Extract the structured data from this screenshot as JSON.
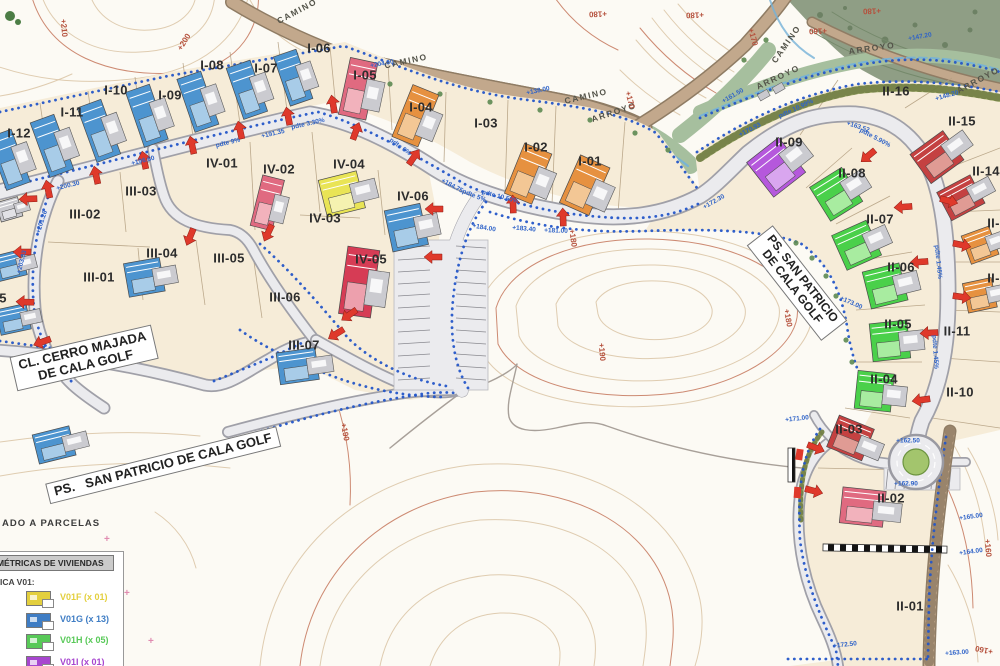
{
  "map_title": "Plano de parcelación - Cala Golf",
  "colors": {
    "paper": "#fcfaf4",
    "parcel": "#f6ecd8",
    "road_fill": "#ebebee",
    "road_edge": "#a0a0a8",
    "boundary_dots": "#2456c8",
    "arrow": "#df392b",
    "contour": "#dcc7a8",
    "contour_index": "#c4765a",
    "camino": "#c2a88c",
    "camino_edge": "#8f7c64",
    "arroyo_strip": "#a6bf9e",
    "forest": "#89997e",
    "bank": "#93a35b",
    "stream": "#74b2d8",
    "buildings": {
      "blue": {
        "main": "#4d94cf",
        "light": "#a8cce8"
      },
      "pink": {
        "main": "#e06a80",
        "light": "#f2b2bc"
      },
      "crimson": {
        "main": "#d63c55",
        "light": "#eda0ad"
      },
      "red": {
        "main": "#c44141",
        "light": "#e09b94"
      },
      "orange": {
        "main": "#e69140",
        "light": "#f3c795"
      },
      "yellow": {
        "main": "#e9e455",
        "light": "#f5f2b0"
      },
      "green": {
        "main": "#4ad04a",
        "light": "#a8eca0"
      },
      "purple": {
        "main": "#b558dc",
        "light": "#d9a6ef"
      },
      "grey": {
        "main": "#c9c9ce",
        "light": "#e2e2e6"
      }
    }
  },
  "legend": {
    "note": "ADO A PARCELAS",
    "title": "OLUMÉTRICAS DE VIVIENDAS",
    "subtitle": "ICA V01:",
    "items": [
      {
        "label": "V01F (x 01)",
        "color": "#e3cf3e"
      },
      {
        "label": "V01G (x 13)",
        "color": "#3f7dc4"
      },
      {
        "label": "V01H (x 05)",
        "color": "#58c958"
      },
      {
        "label": "V01I (x 01)",
        "color": "#a746cf"
      }
    ]
  },
  "road_labels": [
    {
      "id": "cerro-majada",
      "lines": [
        "CL. CERRO MAJADA",
        "DE CALA GOLF"
      ],
      "x": 84,
      "y": 358,
      "rot": -13,
      "fs": 13
    },
    {
      "id": "san-patricio-sur",
      "lines": [
        "PS.   SAN PATRICIO DE CALA GOLF"
      ],
      "x": 163,
      "y": 465,
      "rot": -14,
      "fs": 13
    },
    {
      "id": "san-patricio-este",
      "lines": [
        "PS. SAN PATRICIO",
        "DE CALA GOLF"
      ],
      "x": 797,
      "y": 283,
      "rot": 52,
      "fs": 12
    }
  ],
  "parcels": [
    {
      "id": "I-12",
      "x": 19,
      "y": 133
    },
    {
      "id": "I-11",
      "x": 72,
      "y": 112
    },
    {
      "id": "I-10",
      "x": 116,
      "y": 90
    },
    {
      "id": "I-09",
      "x": 170,
      "y": 95
    },
    {
      "id": "I-08",
      "x": 212,
      "y": 65
    },
    {
      "id": "I-07",
      "x": 266,
      "y": 68
    },
    {
      "id": "I-06",
      "x": 319,
      "y": 48
    },
    {
      "id": "I-05",
      "x": 365,
      "y": 75
    },
    {
      "id": "I-04",
      "x": 421,
      "y": 107
    },
    {
      "id": "I-03",
      "x": 486,
      "y": 123
    },
    {
      "id": "I-02",
      "x": 536,
      "y": 147
    },
    {
      "id": "I-01",
      "x": 590,
      "y": 161
    },
    {
      "id": "I-14",
      "x": -13,
      "y": 241
    },
    {
      "id": "I-15",
      "x": -5,
      "y": 298
    },
    {
      "id": "IV-01",
      "x": 222,
      "y": 163
    },
    {
      "id": "IV-02",
      "x": 279,
      "y": 169
    },
    {
      "id": "IV-03",
      "x": 325,
      "y": 218
    },
    {
      "id": "IV-04",
      "x": 349,
      "y": 164
    },
    {
      "id": "IV-05",
      "x": 371,
      "y": 259
    },
    {
      "id": "IV-06",
      "x": 413,
      "y": 196
    },
    {
      "id": "III-01",
      "x": 99,
      "y": 277
    },
    {
      "id": "III-02",
      "x": 85,
      "y": 214
    },
    {
      "id": "III-03",
      "x": 141,
      "y": 191
    },
    {
      "id": "III-04",
      "x": 162,
      "y": 253
    },
    {
      "id": "III-05",
      "x": 229,
      "y": 258
    },
    {
      "id": "III-06",
      "x": 285,
      "y": 297
    },
    {
      "id": "III-07",
      "x": 304,
      "y": 345
    },
    {
      "id": "II-01",
      "x": 910,
      "y": 606
    },
    {
      "id": "II-02",
      "x": 891,
      "y": 498
    },
    {
      "id": "II-03",
      "x": 849,
      "y": 429
    },
    {
      "id": "II-04",
      "x": 884,
      "y": 379
    },
    {
      "id": "II-05",
      "x": 898,
      "y": 324
    },
    {
      "id": "II-06",
      "x": 901,
      "y": 267
    },
    {
      "id": "II-07",
      "x": 880,
      "y": 219
    },
    {
      "id": "II-08",
      "x": 852,
      "y": 173
    },
    {
      "id": "II-09",
      "x": 789,
      "y": 142
    },
    {
      "id": "II-10",
      "x": 960,
      "y": 392
    },
    {
      "id": "II-11",
      "x": 957,
      "y": 331
    },
    {
      "id": "II-12",
      "x": 1001,
      "y": 278
    },
    {
      "id": "II-13",
      "x": 1001,
      "y": 223
    },
    {
      "id": "II-14",
      "x": 986,
      "y": 171
    },
    {
      "id": "II-15",
      "x": 962,
      "y": 121
    },
    {
      "id": "II-16",
      "x": 896,
      "y": 91
    }
  ],
  "path_labels": [
    {
      "t": "CAMINO",
      "x": 297,
      "y": 11,
      "r": -28
    },
    {
      "t": "CAMINO",
      "x": 406,
      "y": 61,
      "r": -12
    },
    {
      "t": "CAMINO",
      "x": 586,
      "y": 96,
      "r": -13
    },
    {
      "t": "CAMINO",
      "x": 786,
      "y": 44,
      "r": -55
    },
    {
      "t": "ARROYO",
      "x": 614,
      "y": 112,
      "r": -18
    },
    {
      "t": "ARROYO",
      "x": 778,
      "y": 77,
      "r": -25
    },
    {
      "t": "ARROYO",
      "x": 872,
      "y": 48,
      "r": -8
    },
    {
      "t": "ARROYO",
      "x": 978,
      "y": 80,
      "r": -28
    }
  ],
  "contour_labels": [
    {
      "t": "+210",
      "x": 64,
      "y": 28,
      "r": 85
    },
    {
      "t": "+200",
      "x": 184,
      "y": 42,
      "r": -58
    },
    {
      "t": "+180",
      "x": 598,
      "y": 14,
      "r": 178
    },
    {
      "t": "+180",
      "x": 695,
      "y": 15,
      "r": 178
    },
    {
      "t": "+170",
      "x": 753,
      "y": 37,
      "r": 75
    },
    {
      "t": "+160",
      "x": 818,
      "y": 31,
      "r": 178
    },
    {
      "t": "+180",
      "x": 872,
      "y": 11,
      "r": 178
    },
    {
      "t": "+170",
      "x": 630,
      "y": 100,
      "r": 75
    },
    {
      "t": "+180",
      "x": 573,
      "y": 238,
      "r": 82
    },
    {
      "t": "+190",
      "x": 602,
      "y": 352,
      "r": 85
    },
    {
      "t": "+180",
      "x": 788,
      "y": 318,
      "r": 80
    },
    {
      "t": "+190",
      "x": 345,
      "y": 432,
      "r": 80
    },
    {
      "t": "+160",
      "x": 984,
      "y": 650,
      "r": -168
    },
    {
      "t": "+160",
      "x": 988,
      "y": 548,
      "r": 85
    }
  ],
  "annotations": [
    {
      "t": "+204.00",
      "x": 382,
      "y": 64,
      "r": -10
    },
    {
      "t": "+200.30",
      "x": 68,
      "y": 186,
      "r": -14
    },
    {
      "t": "+201.26",
      "x": 42,
      "y": 222,
      "r": -72
    },
    {
      "t": "+203.33",
      "x": 22,
      "y": 262,
      "r": -76
    },
    {
      "t": "+196.60",
      "x": 143,
      "y": 161,
      "r": -14
    },
    {
      "t": "pdte 9%",
      "x": 228,
      "y": 143,
      "r": -14
    },
    {
      "t": "+191.35",
      "x": 273,
      "y": 134,
      "r": -13
    },
    {
      "t": "pdte 3.30%",
      "x": 308,
      "y": 124,
      "r": -13
    },
    {
      "t": "pdte 6%",
      "x": 400,
      "y": 147,
      "r": 36
    },
    {
      "t": "+184.75",
      "x": 452,
      "y": 186,
      "r": 28
    },
    {
      "t": "pdte 5%",
      "x": 474,
      "y": 196,
      "r": 22
    },
    {
      "t": "+184.00",
      "x": 484,
      "y": 228,
      "r": 10
    },
    {
      "t": "+183.40",
      "x": 524,
      "y": 229,
      "r": 5
    },
    {
      "t": "+181.00",
      "x": 556,
      "y": 231,
      "r": 2
    },
    {
      "t": "+138.00",
      "x": 538,
      "y": 91,
      "r": -12
    },
    {
      "t": "+161.50",
      "x": 733,
      "y": 96,
      "r": -30
    },
    {
      "t": "+172.30",
      "x": 714,
      "y": 202,
      "r": -30
    },
    {
      "t": "pdte 10.99%",
      "x": 796,
      "y": 109,
      "r": -25
    },
    {
      "t": "+170.93",
      "x": 750,
      "y": 130,
      "r": -27
    },
    {
      "t": "+163.52",
      "x": 858,
      "y": 127,
      "r": 18
    },
    {
      "t": "pdte 5.90%",
      "x": 875,
      "y": 138,
      "r": 28
    },
    {
      "t": "+147.20",
      "x": 920,
      "y": 37,
      "r": -10
    },
    {
      "t": "+148.20",
      "x": 947,
      "y": 96,
      "r": -16
    },
    {
      "t": "pdte 1.45%",
      "x": 938,
      "y": 262,
      "r": 84
    },
    {
      "t": "pdte 1.45%",
      "x": 935,
      "y": 352,
      "r": 86
    },
    {
      "t": "+173.00",
      "x": 851,
      "y": 303,
      "r": 24
    },
    {
      "t": "+162.50",
      "x": 908,
      "y": 441,
      "r": 0
    },
    {
      "t": "+162.90",
      "x": 906,
      "y": 484,
      "r": 0
    },
    {
      "t": "+165.00",
      "x": 971,
      "y": 517,
      "r": -8
    },
    {
      "t": "+164.00",
      "x": 971,
      "y": 552,
      "r": -8
    },
    {
      "t": "+163.00",
      "x": 957,
      "y": 653,
      "r": -4
    },
    {
      "t": "+172.50",
      "x": 845,
      "y": 645,
      "r": -6
    },
    {
      "t": "+171.00",
      "x": 797,
      "y": 419,
      "r": -6
    },
    {
      "t": "pdte 10.50%",
      "x": 500,
      "y": 197,
      "r": 15
    }
  ],
  "buildings": [
    {
      "x": 14,
      "y": 158,
      "w": 36,
      "h": 56,
      "r": -20,
      "c": "blue"
    },
    {
      "x": 57,
      "y": 144,
      "w": 36,
      "h": 58,
      "r": -20,
      "c": "blue"
    },
    {
      "x": 104,
      "y": 129,
      "w": 36,
      "h": 58,
      "r": -20,
      "c": "blue"
    },
    {
      "x": 152,
      "y": 114,
      "w": 36,
      "h": 58,
      "r": -19,
      "c": "blue"
    },
    {
      "x": 203,
      "y": 100,
      "w": 36,
      "h": 56,
      "r": -19,
      "c": "blue"
    },
    {
      "x": 252,
      "y": 88,
      "w": 36,
      "h": 54,
      "r": -19,
      "c": "blue"
    },
    {
      "x": 298,
      "y": 76,
      "w": 34,
      "h": 52,
      "r": -19,
      "c": "blue"
    },
    {
      "x": 364,
      "y": 90,
      "w": 40,
      "h": 58,
      "r": 12,
      "c": "pink"
    },
    {
      "x": 421,
      "y": 118,
      "w": 40,
      "h": 56,
      "r": 22,
      "c": "orange"
    },
    {
      "x": 534,
      "y": 176,
      "w": 42,
      "h": 54,
      "r": 22,
      "c": "orange"
    },
    {
      "x": 591,
      "y": 188,
      "w": 46,
      "h": 52,
      "r": 24,
      "c": "orange"
    },
    {
      "x": 350,
      "y": 192,
      "w": 56,
      "h": 38,
      "r": -14,
      "c": "yellow"
    },
    {
      "x": 414,
      "y": 226,
      "w": 52,
      "h": 42,
      "r": -12,
      "c": "blue"
    },
    {
      "x": 272,
      "y": 204,
      "w": 32,
      "h": 52,
      "r": 14,
      "c": "pink"
    },
    {
      "x": 366,
      "y": 283,
      "w": 46,
      "h": 68,
      "r": 8,
      "c": "crimson"
    },
    {
      "x": 152,
      "y": 276,
      "w": 52,
      "h": 34,
      "r": -10,
      "c": "blue"
    },
    {
      "x": 306,
      "y": 365,
      "w": 56,
      "h": 32,
      "r": -8,
      "c": "blue"
    },
    {
      "x": 783,
      "y": 162,
      "w": 58,
      "h": 44,
      "r": -38,
      "c": "purple"
    },
    {
      "x": 843,
      "y": 190,
      "w": 54,
      "h": 40,
      "r": -32,
      "c": "green"
    },
    {
      "x": 864,
      "y": 242,
      "w": 54,
      "h": 38,
      "r": -24,
      "c": "green"
    },
    {
      "x": 893,
      "y": 284,
      "w": 54,
      "h": 38,
      "r": -14,
      "c": "green"
    },
    {
      "x": 898,
      "y": 340,
      "w": 54,
      "h": 38,
      "r": -6,
      "c": "green"
    },
    {
      "x": 882,
      "y": 392,
      "w": 52,
      "h": 38,
      "r": 6,
      "c": "green"
    },
    {
      "x": 944,
      "y": 152,
      "w": 58,
      "h": 36,
      "r": -36,
      "c": "red"
    },
    {
      "x": 968,
      "y": 194,
      "w": 54,
      "h": 32,
      "r": -28,
      "c": "red"
    },
    {
      "x": 986,
      "y": 243,
      "w": 42,
      "h": 30,
      "r": -20,
      "c": "orange"
    },
    {
      "x": 986,
      "y": 294,
      "w": 42,
      "h": 30,
      "r": -12,
      "c": "orange"
    },
    {
      "x": 858,
      "y": 441,
      "w": 54,
      "h": 34,
      "r": 22,
      "c": "red"
    },
    {
      "x": 872,
      "y": 508,
      "w": 62,
      "h": 36,
      "r": 6,
      "c": "pink"
    },
    {
      "x": 16,
      "y": 264,
      "w": 42,
      "h": 26,
      "r": -14,
      "c": "blue"
    },
    {
      "x": 20,
      "y": 318,
      "w": 44,
      "h": 26,
      "r": -12,
      "c": "blue"
    },
    {
      "x": 62,
      "y": 443,
      "w": 54,
      "h": 30,
      "r": -14,
      "c": "blue"
    },
    {
      "x": 14,
      "y": 208,
      "w": 32,
      "h": 20,
      "r": -16,
      "c": "grey"
    }
  ],
  "arrows": [
    {
      "x": 48,
      "y": 189,
      "r": -102
    },
    {
      "x": 96,
      "y": 175,
      "r": -102
    },
    {
      "x": 144,
      "y": 160,
      "r": -102
    },
    {
      "x": 192,
      "y": 145,
      "r": -102
    },
    {
      "x": 240,
      "y": 130,
      "r": -102
    },
    {
      "x": 288,
      "y": 116,
      "r": -101
    },
    {
      "x": 333,
      "y": 104,
      "r": -100
    },
    {
      "x": 356,
      "y": 131,
      "r": -70
    },
    {
      "x": 414,
      "y": 157,
      "r": -55
    },
    {
      "x": 513,
      "y": 204,
      "r": -92
    },
    {
      "x": 563,
      "y": 217,
      "r": -92
    },
    {
      "x": 28,
      "y": 199,
      "r": 178
    },
    {
      "x": 22,
      "y": 252,
      "r": 180
    },
    {
      "x": 25,
      "y": 302,
      "r": 182
    },
    {
      "x": 42,
      "y": 342,
      "r": 160
    },
    {
      "x": 190,
      "y": 237,
      "r": 112
    },
    {
      "x": 268,
      "y": 233,
      "r": 115
    },
    {
      "x": 434,
      "y": 209,
      "r": 180
    },
    {
      "x": 433,
      "y": 257,
      "r": 180
    },
    {
      "x": 349,
      "y": 315,
      "r": 145
    },
    {
      "x": 336,
      "y": 334,
      "r": 148
    },
    {
      "x": 868,
      "y": 156,
      "r": 140
    },
    {
      "x": 903,
      "y": 207,
      "r": 176
    },
    {
      "x": 919,
      "y": 262,
      "r": 176
    },
    {
      "x": 929,
      "y": 333,
      "r": 177
    },
    {
      "x": 921,
      "y": 400,
      "r": 172
    },
    {
      "x": 949,
      "y": 201,
      "r": 15
    },
    {
      "x": 962,
      "y": 245,
      "r": 12
    },
    {
      "x": 962,
      "y": 297,
      "r": 8
    },
    {
      "x": 816,
      "y": 448,
      "r": 22
    },
    {
      "x": 814,
      "y": 491,
      "r": 15
    }
  ]
}
